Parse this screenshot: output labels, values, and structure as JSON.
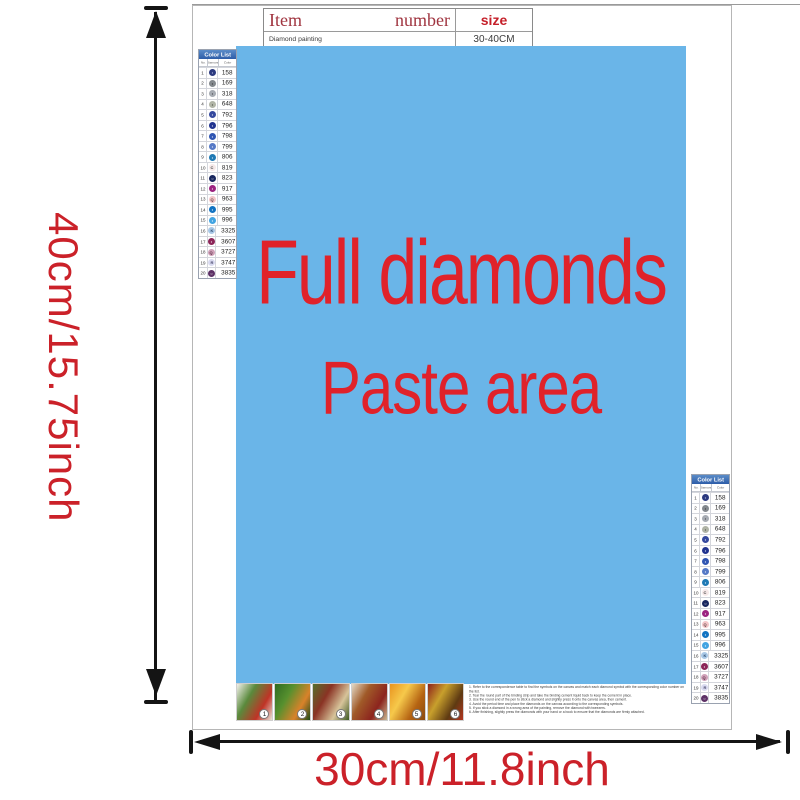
{
  "window": {
    "bg": "#ffffff",
    "canvas_border": "#b6b6b6"
  },
  "item_table": {
    "item_label": "Item",
    "number_label": "number",
    "size_label": "size",
    "product_name": "Diamond painting",
    "size_value": "30-40CM"
  },
  "paste_area": {
    "line1": "Full diamonds",
    "line2": "Paste area",
    "bg_color": "#6ab5e8",
    "text_color": "#e0222a"
  },
  "dimensions": {
    "height_label": "40cm/15.75inch",
    "width_label": "30cm/11.8inch",
    "label_color": "#cb2129",
    "arrow_color": "#141414"
  },
  "color_list": {
    "title": "Color List",
    "columns": [
      "No.",
      "Diamond",
      "Color"
    ],
    "rows": [
      {
        "no": "1",
        "sym": "•",
        "code": "158",
        "fill": "#2c3a80",
        "sym_color": "#cfd6ee"
      },
      {
        "no": "2",
        "sym": "•",
        "code": "169",
        "fill": "#83888d",
        "sym_color": "#2c2c2c"
      },
      {
        "no": "3",
        "sym": "•",
        "code": "318",
        "fill": "#a6abb2",
        "sym_color": "#33343a"
      },
      {
        "no": "4",
        "sym": "•",
        "code": "648",
        "fill": "#b0b4a6",
        "sym_color": "#3a3d34"
      },
      {
        "no": "5",
        "sym": "•",
        "code": "792",
        "fill": "#35499e",
        "sym_color": "#ffffff"
      },
      {
        "no": "6",
        "sym": "•",
        "code": "796",
        "fill": "#20338f",
        "sym_color": "#ffffff"
      },
      {
        "no": "7",
        "sym": "•",
        "code": "798",
        "fill": "#2f55b2",
        "sym_color": "#ffffff"
      },
      {
        "no": "8",
        "sym": "•",
        "code": "799",
        "fill": "#5579c6",
        "sym_color": "#ffffff"
      },
      {
        "no": "9",
        "sym": "•",
        "code": "806",
        "fill": "#1e79b4",
        "sym_color": "#ffffff"
      },
      {
        "no": "10",
        "sym": "C",
        "code": "819",
        "fill": "#f6e9e9",
        "sym_color": "#444444"
      },
      {
        "no": "11",
        "sym": "○",
        "code": "823",
        "fill": "#18265e",
        "sym_color": "#ffffff"
      },
      {
        "no": "12",
        "sym": "•",
        "code": "917",
        "fill": "#9c2380",
        "sym_color": "#ffffff"
      },
      {
        "no": "13",
        "sym": "Q",
        "code": "963",
        "fill": "#f3c5c8",
        "sym_color": "#5a4040"
      },
      {
        "no": "14",
        "sym": "•",
        "code": "995",
        "fill": "#1273c2",
        "sym_color": "#ffffff"
      },
      {
        "no": "15",
        "sym": "•",
        "code": "996",
        "fill": "#42a4e2",
        "sym_color": "#ffffff"
      },
      {
        "no": "16",
        "sym": "K",
        "code": "3325",
        "fill": "#a9c8e6",
        "sym_color": "#2a4a6e"
      },
      {
        "no": "17",
        "sym": "•",
        "code": "3607",
        "fill": "#8c2558",
        "sym_color": "#ffffff"
      },
      {
        "no": "18",
        "sym": "Q",
        "code": "3727",
        "fill": "#cfa0b8",
        "sym_color": "#5a2c44"
      },
      {
        "no": "19",
        "sym": "R",
        "code": "3747",
        "fill": "#d9daf0",
        "sym_color": "#4a4a6e"
      },
      {
        "no": "20",
        "sym": "○",
        "code": "3835",
        "fill": "#5d3166",
        "sym_color": "#ffffff"
      }
    ]
  },
  "steps": [
    {
      "number": "1",
      "colors": [
        "#f2f0ea",
        "#5a8a3c",
        "#c03326",
        "#e8e4da"
      ]
    },
    {
      "number": "2",
      "colors": [
        "#2f6b22",
        "#57902e",
        "#d9822a",
        "#1d4a16"
      ]
    },
    {
      "number": "3",
      "colors": [
        "#55702c",
        "#8a3324",
        "#d7c49a",
        "#3d5a22"
      ]
    },
    {
      "number": "4",
      "colors": [
        "#e3d9c6",
        "#a05a28",
        "#8c241e",
        "#c9b892"
      ]
    },
    {
      "number": "5",
      "colors": [
        "#e9941f",
        "#f6c94b",
        "#b56312",
        "#8a4a10"
      ]
    },
    {
      "number": "6",
      "colors": [
        "#8e211b",
        "#c8a02c",
        "#5e3a12",
        "#b3341f"
      ]
    }
  ],
  "instructions": {
    "lines": [
      "1. Refer to the correspondence table to find the symbols on the canvas and match each diamond symbol with the corresponding color number on the list.",
      "2. Tear the round part of the binding strip and take the binding cement liquid back to keep the cement in place.",
      "3. Use the round end of the pen to stick a diamond and slightly press it onto the canvas area, then cement.",
      "4. Avoid the period time and place the diamonds on the canvas according to the corresponding symbols.",
      "5. If you stick a diamond in a wrong area of the painting, remove the diamond with tweezers.",
      "6. After finishing, slightly press the diamonds with your hand or a book to ensure that the diamonds are firmly attached."
    ]
  }
}
